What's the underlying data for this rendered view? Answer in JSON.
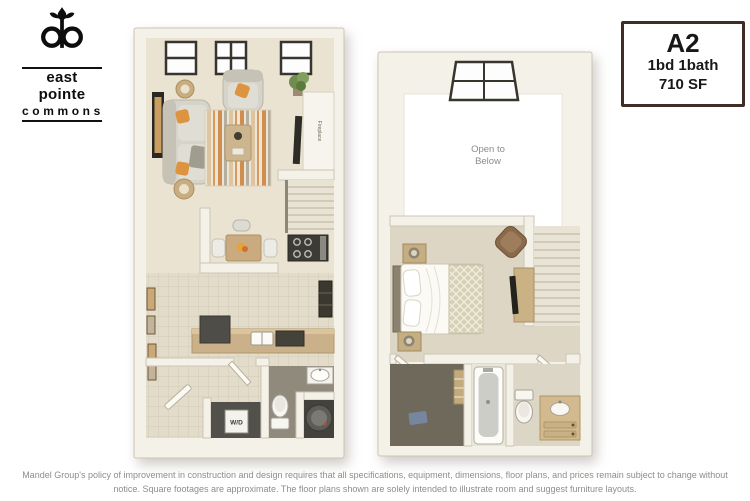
{
  "page": {
    "background_color": "#ffffff"
  },
  "logo": {
    "monogram": "ep",
    "name_line1": "east pointe",
    "name_line2": "commons"
  },
  "info_box": {
    "plan_code": "A2",
    "bed_bath": "1bd 1bath",
    "square_feet": "710 SF",
    "border_color": "#402d26"
  },
  "floorplans": {
    "first_floor": {
      "labels": {
        "fireplace": "Fireplace",
        "washer_dryer": "W/D"
      }
    },
    "second_floor": {
      "labels": {
        "open_to_below_line1": "Open to",
        "open_to_below_line2": "Below"
      }
    },
    "palette": {
      "wall": "#f4f1e8",
      "carpet": "#ebe3d2",
      "tile": "#e3dcca",
      "counter": "#cbb189",
      "accent_orange": "#dc9440",
      "dark_appliance": "#3c3b36",
      "open_area": "#ffffff"
    }
  },
  "disclaimer": "Mandel Group's policy of improvement in construction and design requires that all specifications, equipment, dimensions, floor plans, and prices remain subject to change without notice. Square footages are approximate. The floor plans shown are solely intended to illustrate room and suggest furniture layouts."
}
